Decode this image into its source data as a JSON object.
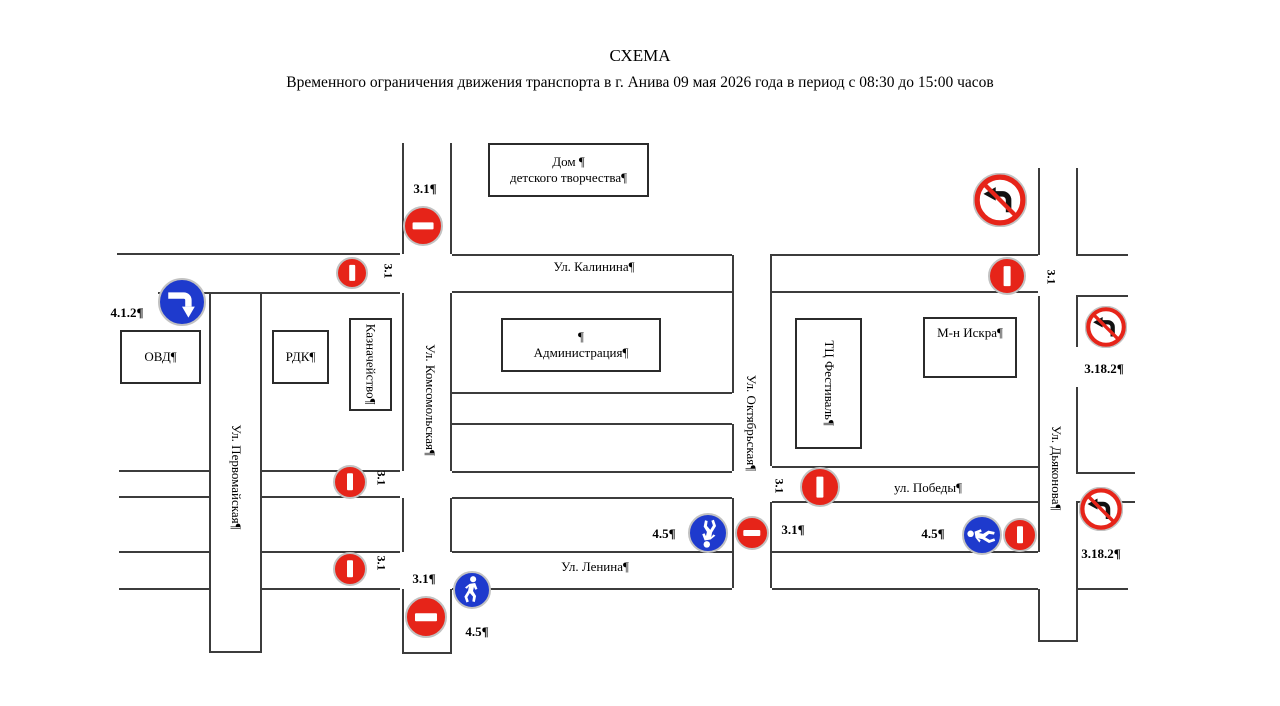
{
  "header": {
    "title": "СХЕМА",
    "subtitle": "Временного ограничения движения транспорта в г. Анива 09 мая 2026 года в период с 08:30 до 15:00 часов"
  },
  "streets": {
    "kalinina": "Ул. Калинина¶",
    "lenina": "Ул. Ленина¶",
    "pobedy": "ул. Победы¶",
    "komsomolskaya": "Ул. Комсомольская¶",
    "pervomayskaya": "Ул. Первомайская¶",
    "oktyabrskaya": "Ул. Октябрьская¶",
    "dyakonova": "Ул. Дьяконова¶"
  },
  "buildings": {
    "dom_tvorchestva_line1": "Дом ¶",
    "dom_tvorchestva_line2": "детского творчества¶",
    "ovd": "ОВД¶",
    "rdk": "РДК¶",
    "kaznacheystvo": "Казначейство¶",
    "admin_line1": "¶",
    "admin_line2": "Администрация¶",
    "festival": "ТЦ Фестиваль¶",
    "iskra": "М-н Искра¶"
  },
  "codes": {
    "no_entry": "3.1¶",
    "no_entry_rot": "3.1",
    "turn_right": "4.1.2¶",
    "ped_path": "4.5¶",
    "no_left_turn": "3.18.2¶"
  },
  "colors": {
    "sign_red": "#e62419",
    "sign_blue": "#1e3acd",
    "road_line": "#3c3c3c"
  }
}
